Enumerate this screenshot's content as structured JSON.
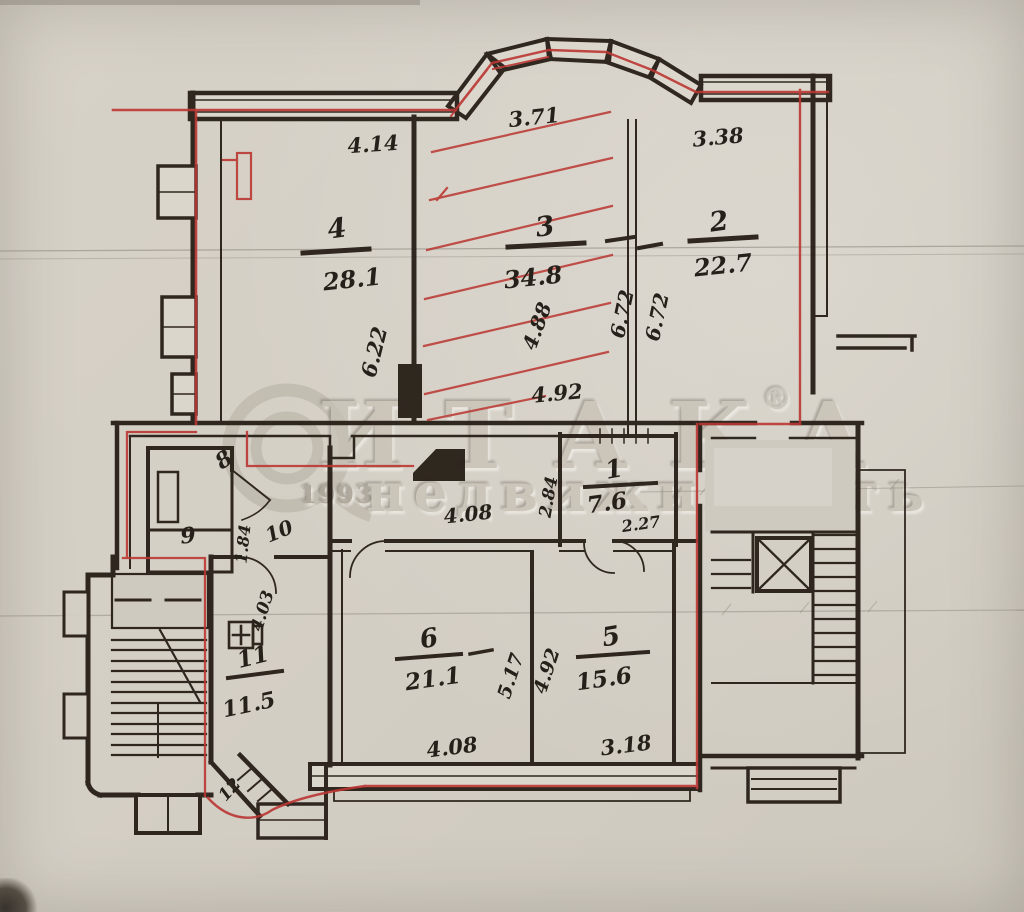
{
  "watermark": {
    "brand": "ИТАКА",
    "registered": "®",
    "year": "1993",
    "subtitle": "недвижимость",
    "corner_mark": "⌐"
  },
  "rooms": {
    "r1": {
      "number": "1",
      "area": "7.6"
    },
    "r2": {
      "number": "2",
      "area": "22.7"
    },
    "r3": {
      "number": "3",
      "area": "34.8"
    },
    "r4": {
      "number": "4",
      "area": "28.1"
    },
    "r5": {
      "number": "5",
      "area": "15.6"
    },
    "r6": {
      "number": "6",
      "area": "21.1"
    },
    "r8": {
      "number": "8"
    },
    "r9": {
      "number": "9"
    },
    "r10": {
      "number": "10"
    },
    "r11": {
      "number": "11",
      "area": "11.5"
    },
    "r12": {
      "number": "12"
    }
  },
  "dimensions": {
    "top_room4_width": "4.14",
    "bay_width": "3.71",
    "top_room2_width": "3.38",
    "room4_depth": "6.22",
    "room3_depth_a": "6.72",
    "room3_depth_b": "6.72",
    "room3_inner": "4.88",
    "room3_width": "4.92",
    "hall_width": "4.08",
    "room1_width": "2.27",
    "room1_depth": "2.84",
    "hall_left_a": "1.84",
    "hall_left_b": "4.03",
    "room6_width": "4.08",
    "room6_depth": "5.17",
    "room5_width": "3.18",
    "room5_depth": "4.92"
  },
  "colors": {
    "paper": "#d4cfc5",
    "ink": "#271f17",
    "markup_red": "#bb3733",
    "watermark": "#c7c1b5"
  }
}
